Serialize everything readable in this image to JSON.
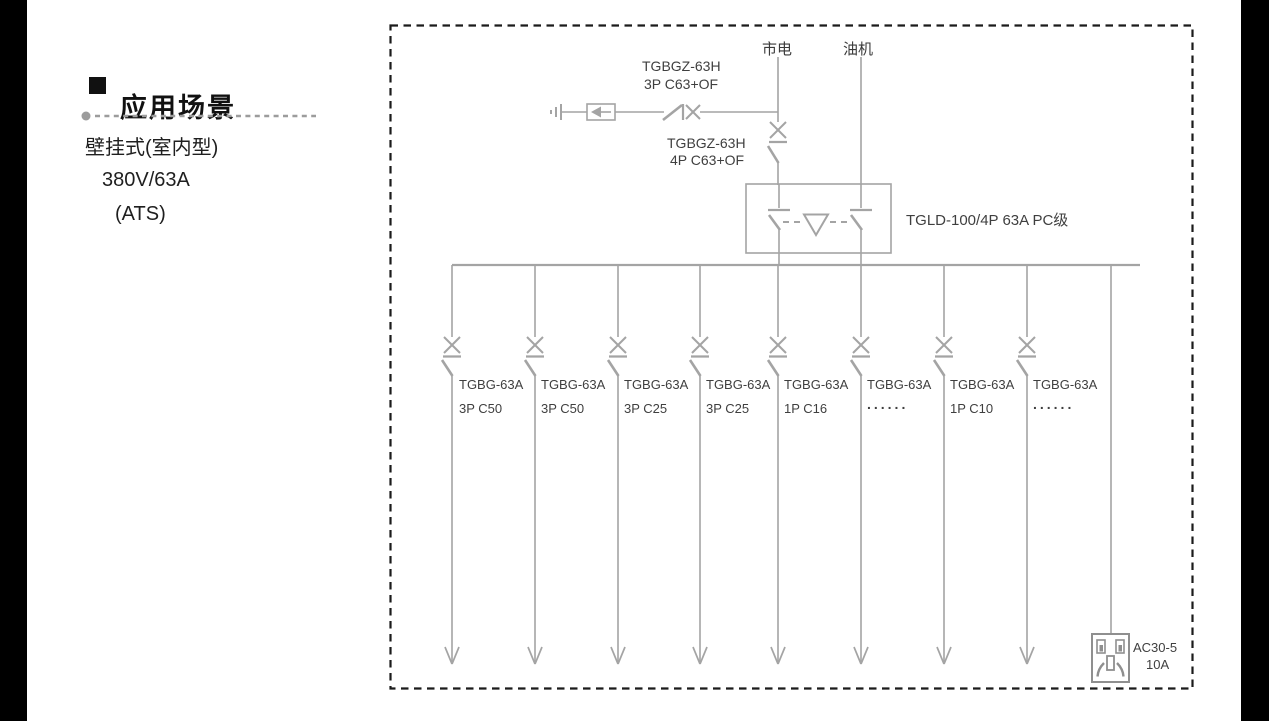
{
  "panel": {
    "title": "应用场景",
    "lines": [
      "壁挂式(室内型)",
      "380V/63A",
      "(ATS)"
    ]
  },
  "diagram": {
    "sources": {
      "mains": "市电",
      "generator": "油机"
    },
    "spd_breaker": {
      "model": "TGBGZ-63H",
      "spec": "3P C63+OF"
    },
    "main_breaker": {
      "model": "TGBGZ-63H",
      "spec": "4P C63+OF"
    },
    "ats": {
      "label": "TGLD-100/4P 63A PC级"
    },
    "branches": [
      {
        "model": "TGBG-63A",
        "spec": "3P C50"
      },
      {
        "model": "TGBG-63A",
        "spec": "3P C50"
      },
      {
        "model": "TGBG-63A",
        "spec": "3P C25"
      },
      {
        "model": "TGBG-63A",
        "spec": "3P C25"
      },
      {
        "model": "TGBG-63A",
        "spec": "1P C16"
      },
      {
        "model": "TGBG-63A",
        "spec": "......"
      },
      {
        "model": "TGBG-63A",
        "spec": "1P C10"
      },
      {
        "model": "TGBG-63A",
        "spec": "......"
      }
    ],
    "socket": {
      "model": "AC30-5",
      "rating": "10A"
    }
  },
  "colors": {
    "wire": "#a4a4a4",
    "border": "#1b1b1b",
    "text": "#3f3f3f",
    "panel_text": "#1f1f1f",
    "divider": "#9c9c9c"
  }
}
